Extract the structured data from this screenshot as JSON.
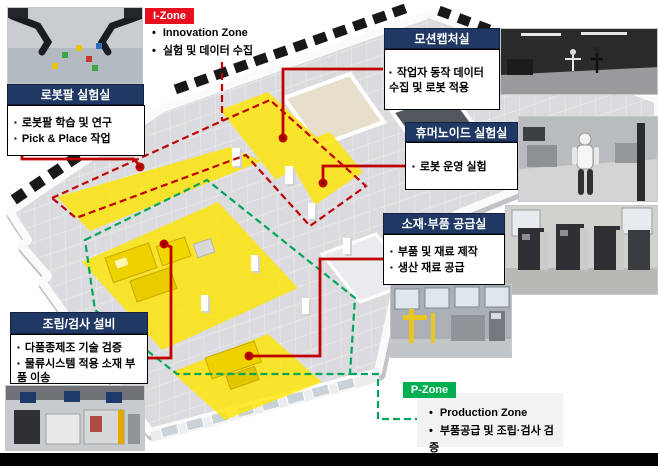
{
  "i_zone": {
    "badge": "I-Zone",
    "items": [
      "Innovation Zone",
      "실험 및 데이터 수집"
    ]
  },
  "p_zone": {
    "badge": "P-Zone",
    "items": [
      "Production Zone",
      "부품공급 및 조립·검사 검증"
    ]
  },
  "callouts": {
    "robot_arm": {
      "title": "로봇팔 실험실",
      "items": [
        "로봇팔 학습 및 연구",
        "Pick & Place 작업"
      ]
    },
    "motion_capture": {
      "title": "모션캡처실",
      "items": [
        "작업자 동작 데이터 수집 및 로봇 적용"
      ]
    },
    "humanoid": {
      "title": "휴머노이드 실험실",
      "items": [
        "로봇 운영 실험"
      ]
    },
    "supply": {
      "title": "소재·부품 공급실",
      "items": [
        "부품 및 재료 제작",
        "생산 재료 공급"
      ]
    },
    "assembly": {
      "title": "조립/검사 설비",
      "items": [
        "다품종제조 기술 검증",
        "물류시스템 적용 소재 부품 이송"
      ]
    }
  },
  "colors": {
    "header_navy": "#1f3864",
    "i_zone_red": "#e8101e",
    "p_zone_green": "#00b050",
    "connector_red": "#c00000",
    "boundary_green": "#00a65a",
    "zone_yellow": "#ffe600",
    "floor_gray": "#dbdbdf"
  }
}
